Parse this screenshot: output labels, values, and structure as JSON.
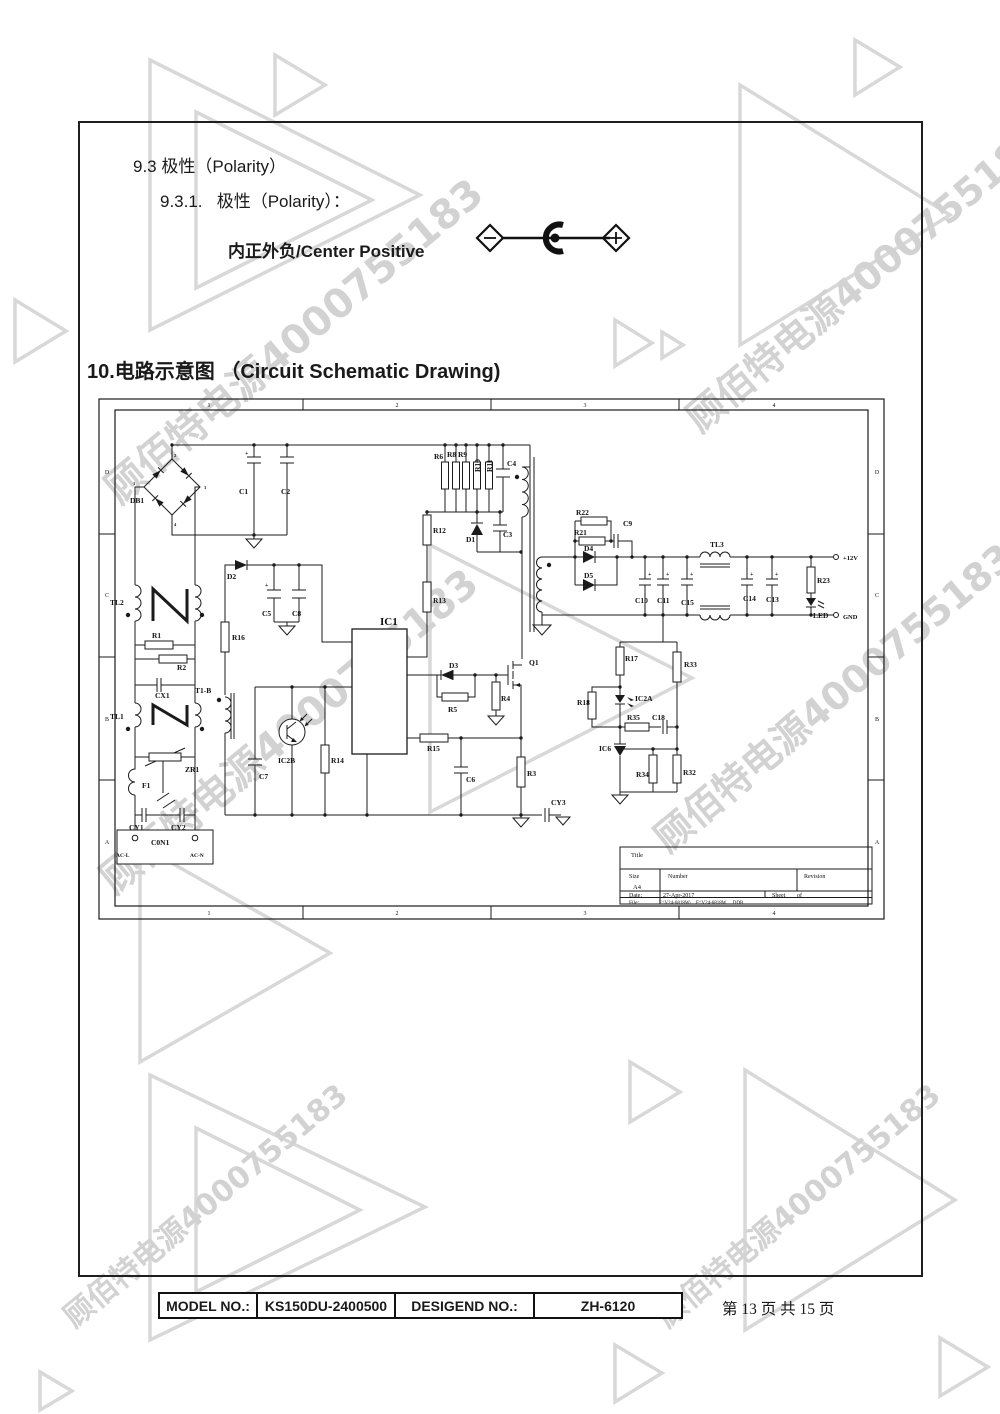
{
  "watermark": {
    "text": "顾佰特电源4000755183",
    "color": "#d2d2d2",
    "instances": [
      {
        "x": 90,
        "y": 470,
        "size": 40,
        "rot": -40
      },
      {
        "x": 672,
        "y": 400,
        "size": 38,
        "rot": -40
      },
      {
        "x": 85,
        "y": 860,
        "size": 40,
        "rot": -40
      },
      {
        "x": 640,
        "y": 820,
        "size": 38,
        "rot": -40
      },
      {
        "x": 52,
        "y": 1302,
        "size": 30,
        "rot": -40
      },
      {
        "x": 645,
        "y": 1302,
        "size": 30,
        "rot": -40
      }
    ]
  },
  "sections": {
    "s93": "9.3 极性（Polarity）",
    "s931": "9.3.1.   极性（Polarity）：",
    "polarity_label": "内正外负/Center Positive",
    "s10": "10.电路示意图 （Circuit Schematic Drawing)"
  },
  "schematic": {
    "labels": [
      {
        "t": "1",
        "x": 112,
        "y": 10,
        "s": 6,
        "a": "m",
        "w": 400
      },
      {
        "t": "2",
        "x": 300,
        "y": 10,
        "s": 6,
        "a": "m",
        "w": 400
      },
      {
        "t": "3",
        "x": 488,
        "y": 10,
        "s": 6,
        "a": "m",
        "w": 400
      },
      {
        "t": "4",
        "x": 677,
        "y": 10,
        "s": 6,
        "a": "m",
        "w": 400
      },
      {
        "t": "1",
        "x": 112,
        "y": 518,
        "s": 6,
        "a": "m",
        "w": 400
      },
      {
        "t": "2",
        "x": 300,
        "y": 518,
        "s": 6,
        "a": "m",
        "w": 400
      },
      {
        "t": "3",
        "x": 488,
        "y": 518,
        "s": 6,
        "a": "m",
        "w": 400
      },
      {
        "t": "4",
        "x": 677,
        "y": 518,
        "s": 6,
        "a": "m",
        "w": 400
      },
      {
        "t": "D",
        "x": 10,
        "y": 77,
        "s": 6,
        "a": "m",
        "w": 400
      },
      {
        "t": "C",
        "x": 10,
        "y": 200,
        "s": 6,
        "a": "m",
        "w": 400
      },
      {
        "t": "B",
        "x": 10,
        "y": 324,
        "s": 6,
        "a": "m",
        "w": 400
      },
      {
        "t": "A",
        "x": 10,
        "y": 447,
        "s": 6,
        "a": "m",
        "w": 400
      },
      {
        "t": "D",
        "x": 780,
        "y": 77,
        "s": 6,
        "a": "m",
        "w": 400
      },
      {
        "t": "C",
        "x": 780,
        "y": 200,
        "s": 6,
        "a": "m",
        "w": 400
      },
      {
        "t": "B",
        "x": 780,
        "y": 324,
        "s": 6,
        "a": "m",
        "w": 400
      },
      {
        "t": "A",
        "x": 780,
        "y": 447,
        "s": 6,
        "a": "m",
        "w": 400
      },
      {
        "t": "DB1",
        "x": 33,
        "y": 106
      },
      {
        "t": "1",
        "x": 36,
        "y": 88,
        "s": 4.5
      },
      {
        "t": "2",
        "x": 77,
        "y": 60,
        "s": 4.5
      },
      {
        "t": "3",
        "x": 107,
        "y": 92,
        "s": 4.5
      },
      {
        "t": "4",
        "x": 77,
        "y": 129,
        "s": 4.5
      },
      {
        "t": "C1",
        "x": 142,
        "y": 97
      },
      {
        "t": "C2",
        "x": 184,
        "y": 97
      },
      {
        "t": "+",
        "x": 148,
        "y": 58,
        "s": 6
      },
      {
        "t": "TL2",
        "x": 13,
        "y": 208
      },
      {
        "t": "R1",
        "x": 55,
        "y": 241
      },
      {
        "t": "R2",
        "x": 80,
        "y": 273
      },
      {
        "t": "CX1",
        "x": 58,
        "y": 301
      },
      {
        "t": "TL1",
        "x": 13,
        "y": 322
      },
      {
        "t": "ZR1",
        "x": 88,
        "y": 375
      },
      {
        "t": "F1",
        "x": 45,
        "y": 391
      },
      {
        "t": "CY1",
        "x": 32,
        "y": 433
      },
      {
        "t": "CY2",
        "x": 74,
        "y": 433
      },
      {
        "t": "C0N1",
        "x": 54,
        "y": 448
      },
      {
        "t": "AC-L",
        "x": 19,
        "y": 460,
        "s": 5.5
      },
      {
        "t": "AC-N",
        "x": 93,
        "y": 460,
        "s": 5.5
      },
      {
        "t": "D2",
        "x": 130,
        "y": 182
      },
      {
        "t": "C5",
        "x": 165,
        "y": 219
      },
      {
        "t": "C8",
        "x": 195,
        "y": 219
      },
      {
        "t": "+",
        "x": 168,
        "y": 190,
        "s": 6
      },
      {
        "t": "R16",
        "x": 135,
        "y": 243
      },
      {
        "t": "T1-B",
        "x": 98,
        "y": 296
      },
      {
        "t": "IC2B",
        "x": 181,
        "y": 366
      },
      {
        "t": "C7",
        "x": 162,
        "y": 382
      },
      {
        "t": "R14",
        "x": 234,
        "y": 366
      },
      {
        "t": "IC1",
        "x": 283,
        "y": 228,
        "s": 11
      },
      {
        "t": "R12",
        "x": 336,
        "y": 136
      },
      {
        "t": "R13",
        "x": 336,
        "y": 206
      },
      {
        "t": "R6",
        "x": 337,
        "y": 62
      },
      {
        "t": "R8",
        "x": 350,
        "y": 60
      },
      {
        "t": "R9",
        "x": 361,
        "y": 60
      },
      {
        "t": "R10",
        "x": 383,
        "y": 75,
        "r": 1
      },
      {
        "t": "R11",
        "x": 395,
        "y": 75,
        "r": 1
      },
      {
        "t": "C4",
        "x": 410,
        "y": 69
      },
      {
        "t": "D1",
        "x": 369,
        "y": 145
      },
      {
        "t": "C3",
        "x": 406,
        "y": 140
      },
      {
        "t": "D3",
        "x": 352,
        "y": 271
      },
      {
        "t": "R5",
        "x": 351,
        "y": 315
      },
      {
        "t": "R4",
        "x": 404,
        "y": 304
      },
      {
        "t": "Q1",
        "x": 432,
        "y": 268
      },
      {
        "t": "R15",
        "x": 330,
        "y": 354
      },
      {
        "t": "C6",
        "x": 369,
        "y": 385
      },
      {
        "t": "R3",
        "x": 430,
        "y": 379
      },
      {
        "t": "CY3",
        "x": 454,
        "y": 408
      },
      {
        "t": "R22",
        "x": 479,
        "y": 118
      },
      {
        "t": "R21",
        "x": 477,
        "y": 138
      },
      {
        "t": "C9",
        "x": 526,
        "y": 129
      },
      {
        "t": "D4",
        "x": 487,
        "y": 154
      },
      {
        "t": "D5",
        "x": 487,
        "y": 181
      },
      {
        "t": "C10",
        "x": 538,
        "y": 206
      },
      {
        "t": "C11",
        "x": 560,
        "y": 206
      },
      {
        "t": "C15",
        "x": 584,
        "y": 208
      },
      {
        "t": "C14",
        "x": 646,
        "y": 204
      },
      {
        "t": "C13",
        "x": 669,
        "y": 205
      },
      {
        "t": "+",
        "x": 551,
        "y": 179,
        "s": 6
      },
      {
        "t": "+",
        "x": 569,
        "y": 179,
        "s": 6
      },
      {
        "t": "+",
        "x": 593,
        "y": 179,
        "s": 6
      },
      {
        "t": "+",
        "x": 653,
        "y": 179,
        "s": 6
      },
      {
        "t": "+",
        "x": 678,
        "y": 179,
        "s": 6
      },
      {
        "t": "TL3",
        "x": 613,
        "y": 150
      },
      {
        "t": "R23",
        "x": 720,
        "y": 186
      },
      {
        "t": "LED",
        "x": 716,
        "y": 221
      },
      {
        "t": "+12V",
        "x": 746,
        "y": 163,
        "s": 6.5
      },
      {
        "t": "GND",
        "x": 746,
        "y": 222,
        "s": 6.5
      },
      {
        "t": "R17",
        "x": 528,
        "y": 264
      },
      {
        "t": "R33",
        "x": 587,
        "y": 270
      },
      {
        "t": "R18",
        "x": 480,
        "y": 308
      },
      {
        "t": "IC2A",
        "x": 538,
        "y": 304
      },
      {
        "t": "R35",
        "x": 530,
        "y": 323
      },
      {
        "t": "C18",
        "x": 555,
        "y": 323
      },
      {
        "t": "IC6",
        "x": 502,
        "y": 354
      },
      {
        "t": "R34",
        "x": 539,
        "y": 380
      },
      {
        "t": "R32",
        "x": 586,
        "y": 378
      },
      {
        "t": "Title",
        "x": 534,
        "y": 460,
        "s": 6.5,
        "w": 400
      },
      {
        "t": "Size",
        "x": 532,
        "y": 481,
        "s": 6,
        "w": 400
      },
      {
        "t": "A4",
        "x": 536,
        "y": 492,
        "s": 6.5,
        "w": 400
      },
      {
        "t": "Number",
        "x": 571,
        "y": 481,
        "s": 6,
        "w": 400
      },
      {
        "t": "Revision",
        "x": 707,
        "y": 481,
        "s": 6,
        "w": 400
      },
      {
        "t": "Date:",
        "x": 532,
        "y": 500,
        "s": 6,
        "w": 400
      },
      {
        "t": "27-Apr-2017",
        "x": 566,
        "y": 500,
        "s": 6,
        "w": 400
      },
      {
        "t": "Sheet",
        "x": 675,
        "y": 500,
        "s": 6,
        "w": 400
      },
      {
        "t": "of",
        "x": 700,
        "y": 500,
        "s": 6,
        "w": 400
      },
      {
        "t": "File:",
        "x": 532,
        "y": 507,
        "s": 5.5,
        "w": 400
      },
      {
        "t": "F:\\V24-6818W\\…F:\\V24-6818W….DDB",
        "x": 562,
        "y": 507,
        "s": 5,
        "w": 400
      }
    ]
  },
  "footer": {
    "model_label": "MODEL NO.:",
    "model_value": "KS150DU-2400500",
    "design_label": "DESIGEND NO.:",
    "design_value": "ZH-6120",
    "page_info": "第 13 页 共 15 页"
  }
}
